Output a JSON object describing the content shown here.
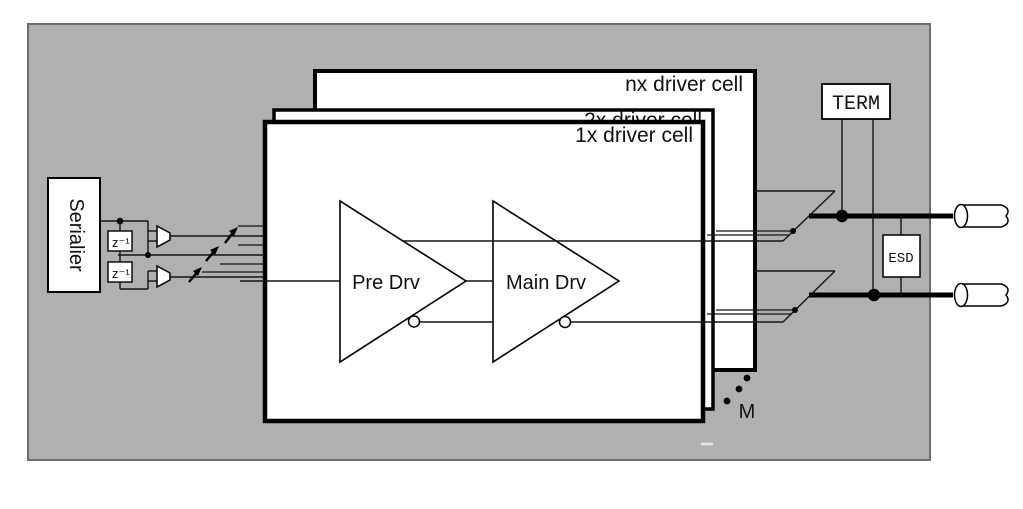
{
  "colors": {
    "panel": "#b0b0b0",
    "panel_border": "#6e6e6e",
    "ink": "#141414"
  },
  "serializer": {
    "label": "Serialier",
    "delay_blocks": [
      "z⁻¹",
      "z⁻¹"
    ]
  },
  "driver_cells": {
    "back_label": "nx driver cell",
    "middle_label": "2x driver cell",
    "front_label": "1x driver cell"
  },
  "amplifiers": {
    "pre_label": "Pre Drv",
    "main_label": "Main Drv"
  },
  "termination": {
    "label": "TERM"
  },
  "esd": {
    "label": "ESD"
  },
  "annotations": {
    "multiplier_label": "M"
  }
}
